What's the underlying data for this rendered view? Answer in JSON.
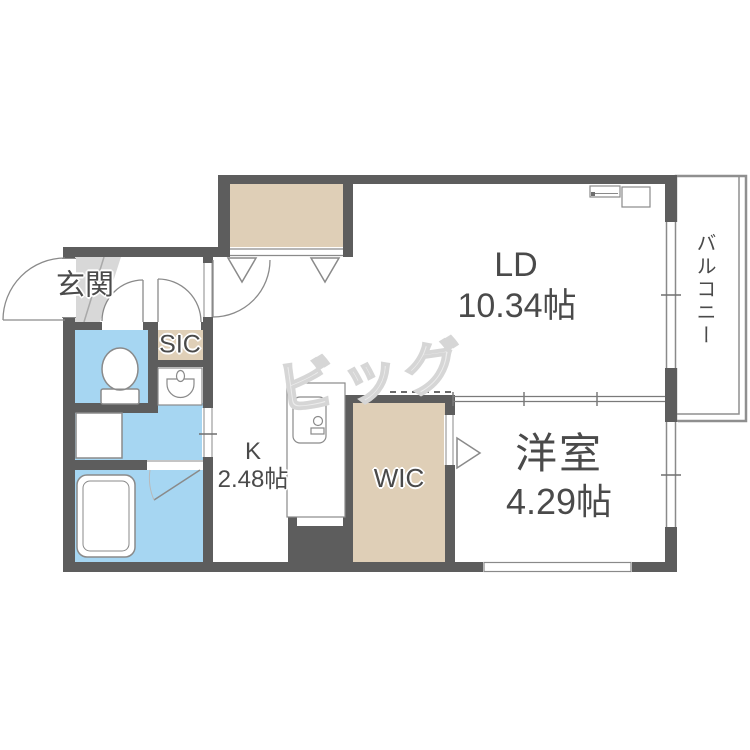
{
  "plan": {
    "rooms": {
      "ld": {
        "name": "LD",
        "size": "10.34帖"
      },
      "bedroom": {
        "name": "洋室",
        "size": "4.29帖"
      },
      "kitchen": {
        "name": "K",
        "size": "2.48帖"
      },
      "wic": {
        "name": "WIC"
      },
      "sic": {
        "name": "SIC"
      },
      "entrance": {
        "name": "玄関"
      },
      "balcony": {
        "name": "バルコニー"
      }
    },
    "watermark": "ビッグ",
    "colors": {
      "wall": "#5d5d5d",
      "water_rooms": "#a6d6f2",
      "storage": "#dfcfb7",
      "entrance_step": "#d8d8d8",
      "fixture_line": "#8a8a8a",
      "label_text": "#4a4a4a",
      "watermark": "#d6d6d6"
    }
  }
}
